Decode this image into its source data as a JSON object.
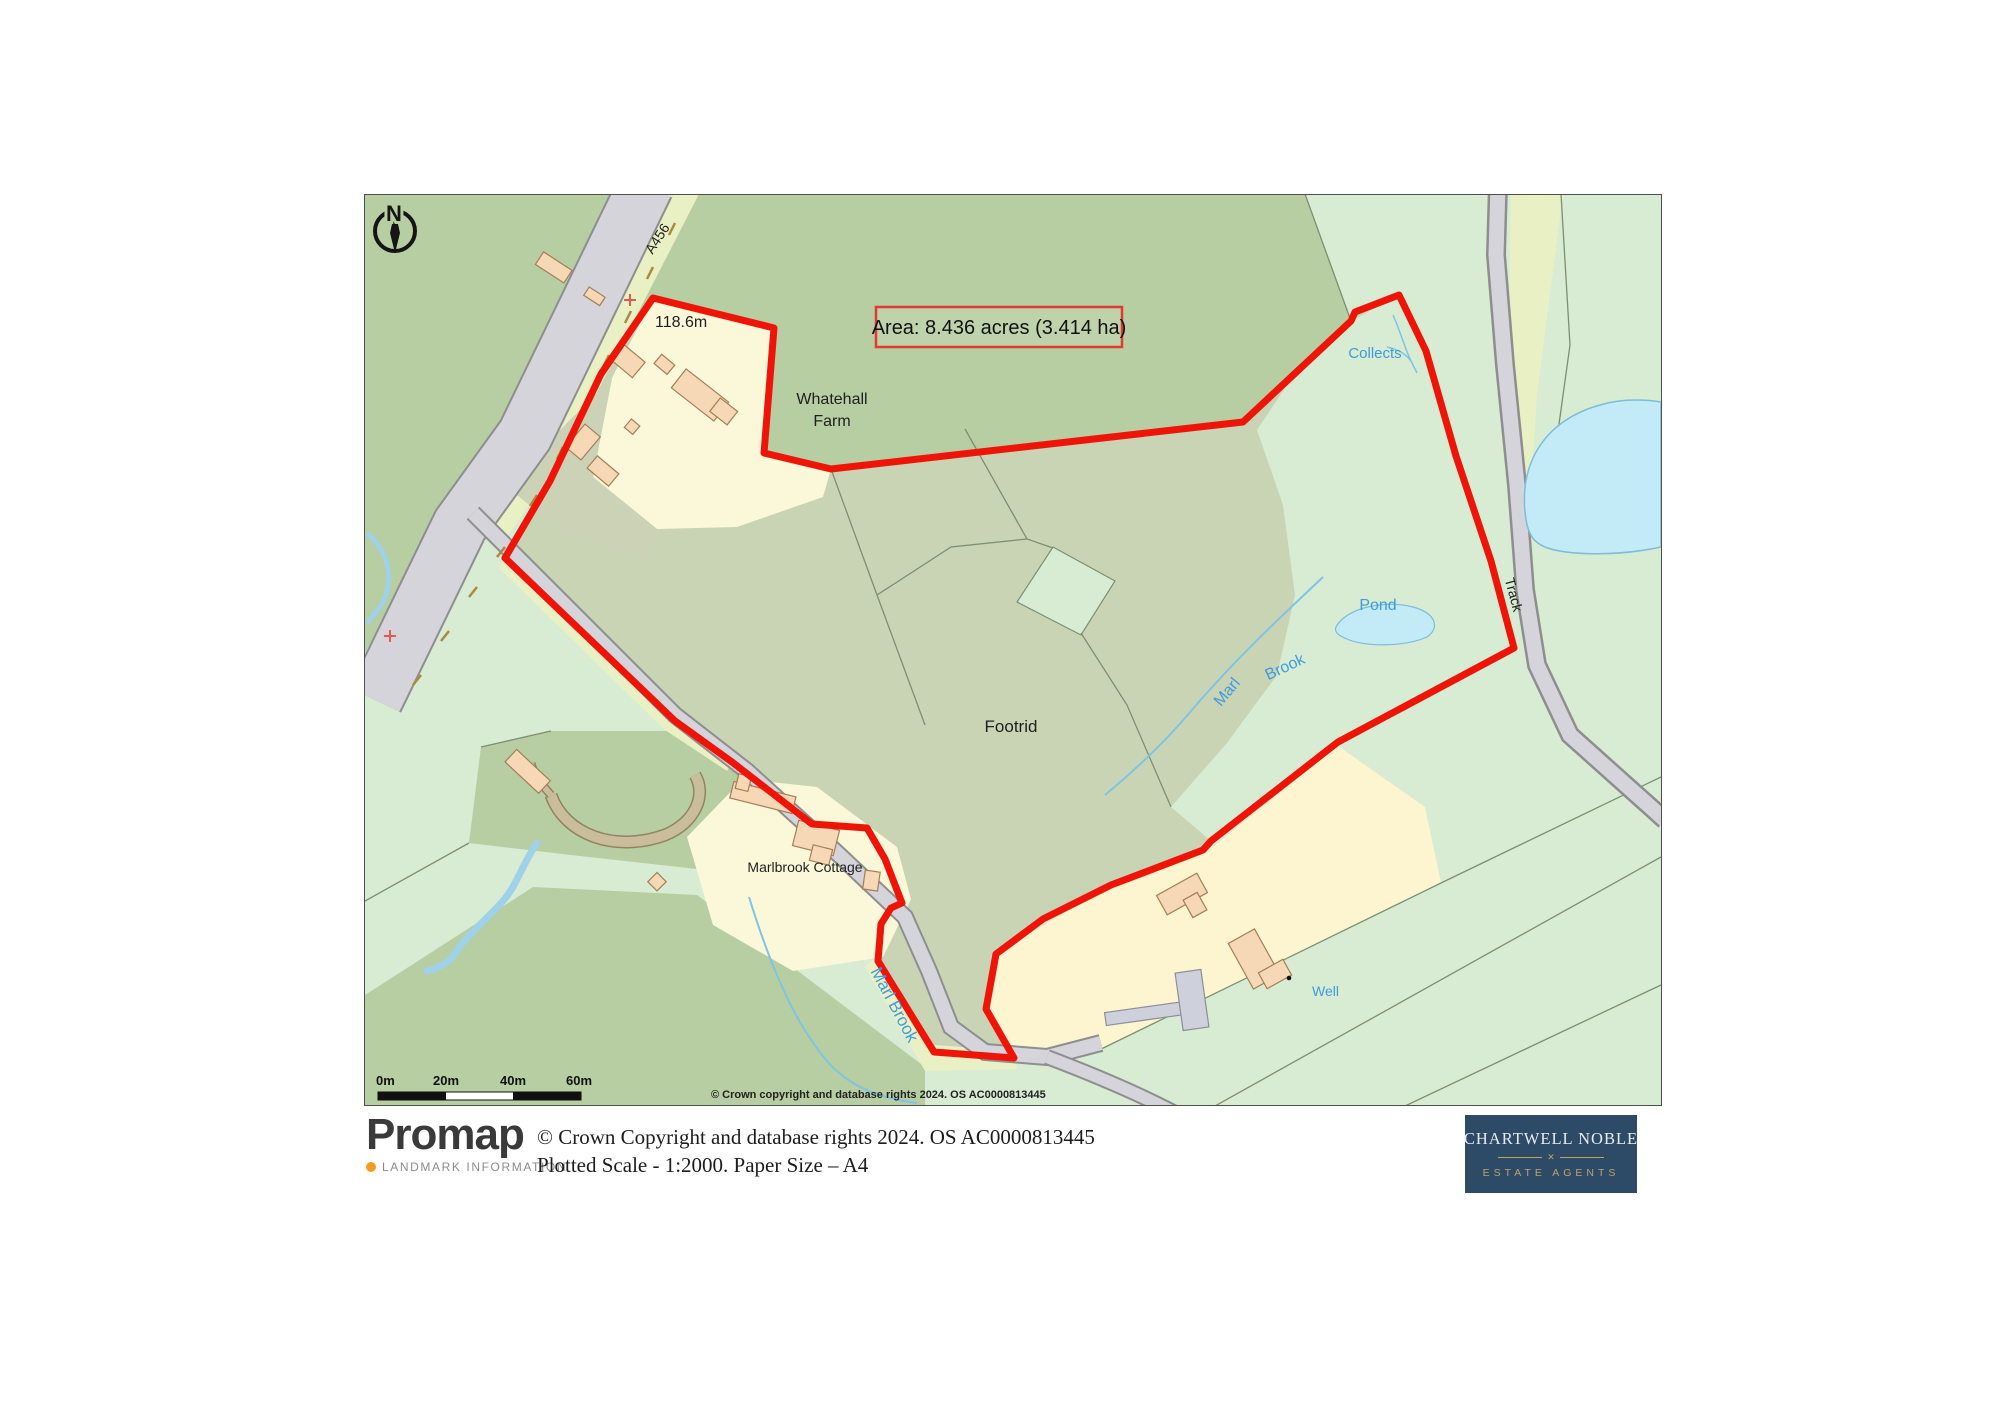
{
  "map": {
    "area_label": "Area: 8.436 acres (3.414 ha)",
    "north_letter": "N",
    "labels": {
      "road": "A456",
      "height": "118.6m",
      "farm_line1": "Whatehall",
      "farm_line2": "Farm",
      "collects": "Collects",
      "pond": "Pond",
      "marl": "Marl",
      "brook": "Brook",
      "track": "Track",
      "footrid": "Footrid",
      "cottage": "Marlbrook Cottage",
      "marl_brook": "Marl Brook",
      "well": "Well"
    },
    "scale_ticks": [
      "0m",
      "20m",
      "40m",
      "60m"
    ],
    "copyright": "© Crown copyright and database rights 2024. OS AC0000813445"
  },
  "footer": {
    "promap_name": "Promap",
    "promap_tagline": "LANDMARK INFORMATION",
    "copyright_line1": "© Crown Copyright and database rights 2024. OS AC0000813445",
    "copyright_line2": "Plotted Scale - 1:2000. Paper Size – A4",
    "agent_name": "CHARTWELL NOBLE",
    "agent_subtitle": "ESTATE AGENTS"
  },
  "colors": {
    "boundary_red": "#ee1408",
    "water_blue_text": "#3e9bdf",
    "agent_navy": "#2d4a67",
    "agent_gold": "#b9a56b",
    "promap_orange": "#f59a23"
  }
}
